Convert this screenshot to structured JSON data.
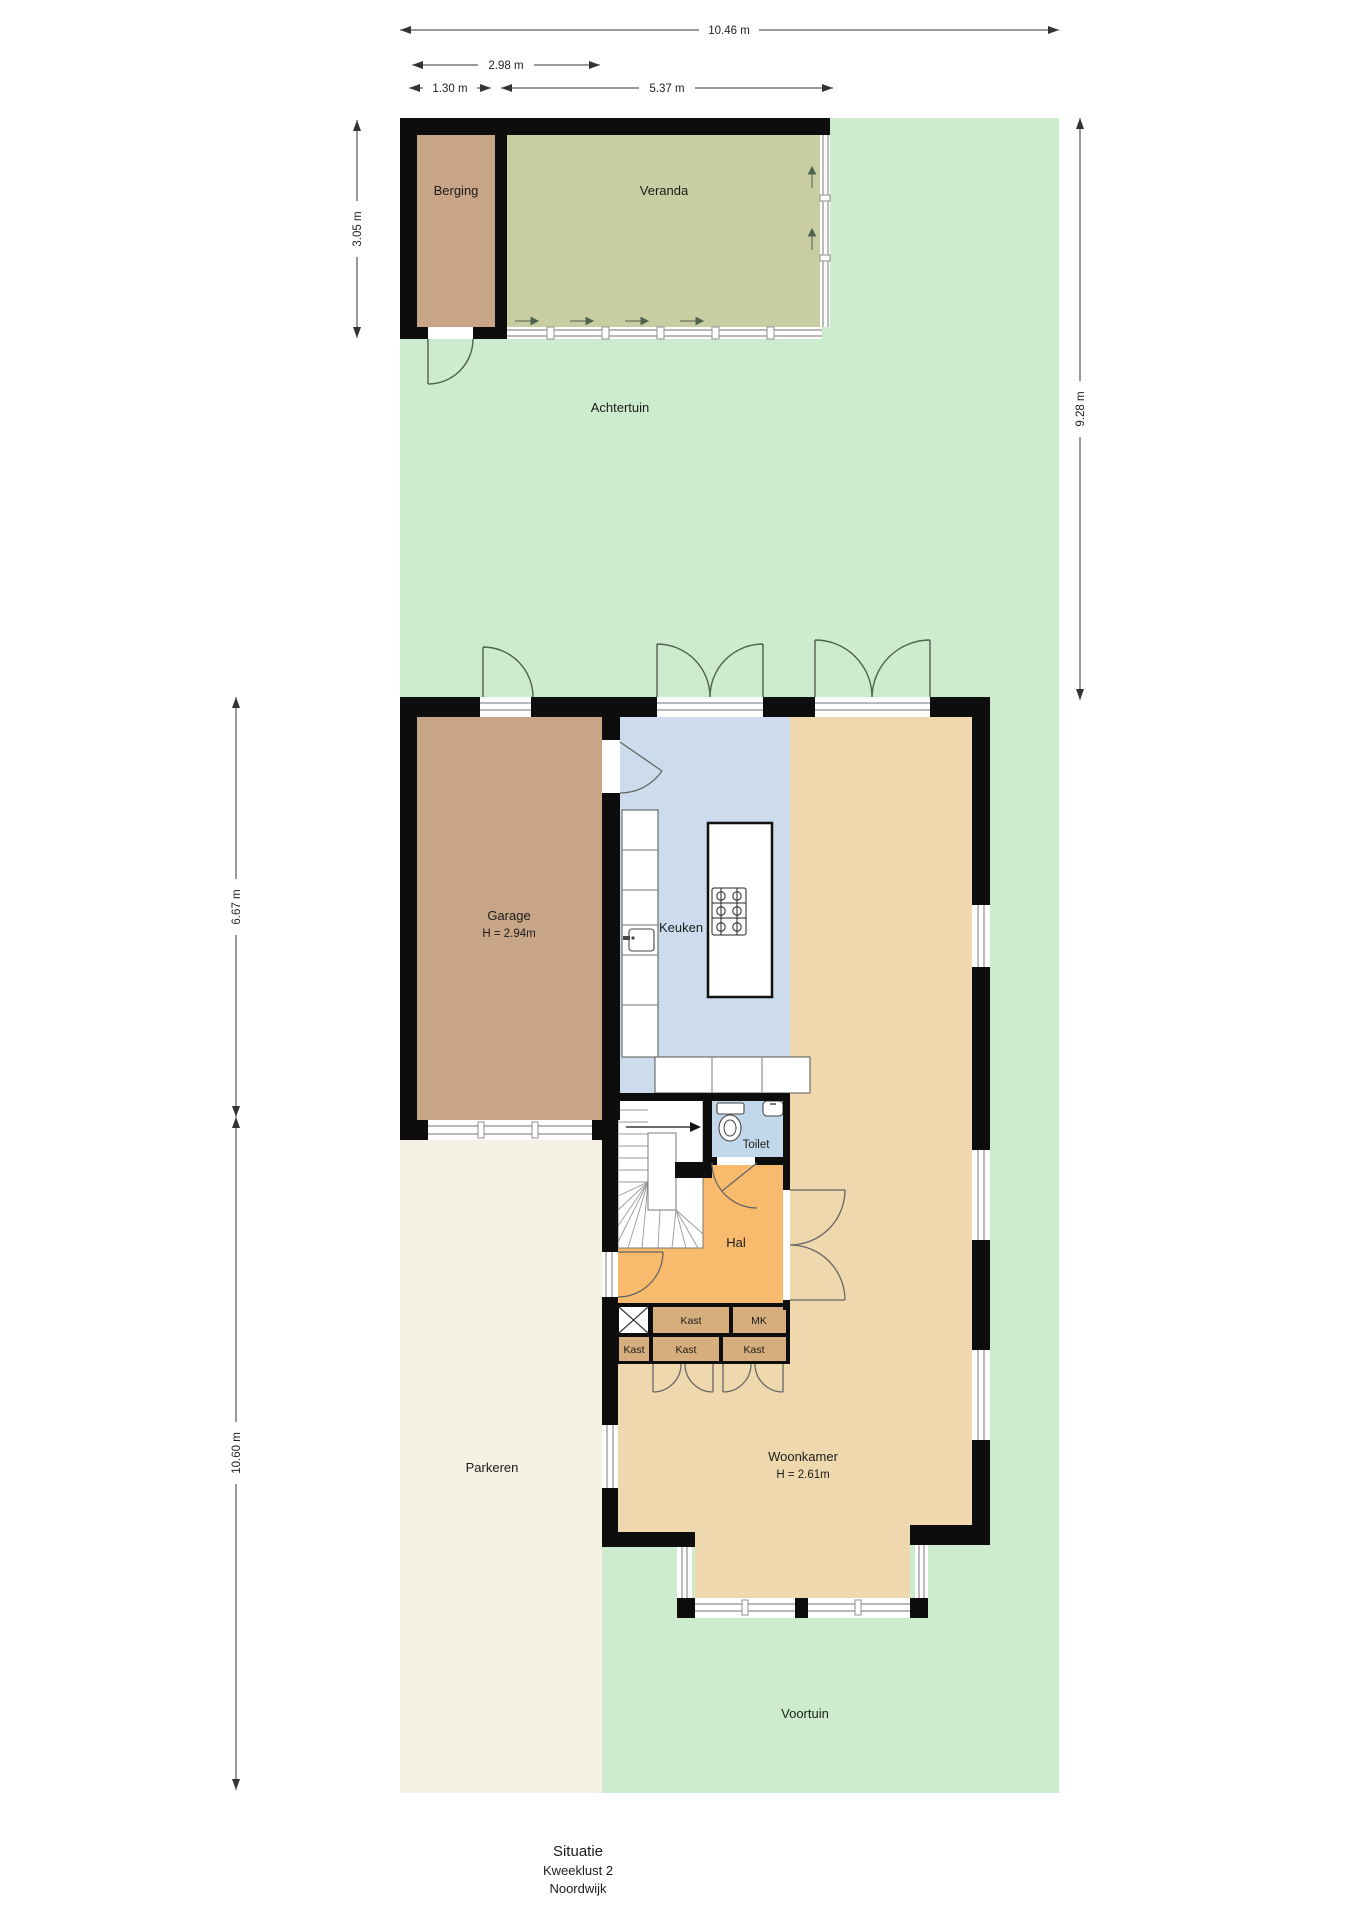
{
  "colors": {
    "garden": "#cdeccd",
    "parkeren": "#f4f1e4",
    "veranda": "#c9cda2",
    "berging": "#c7a586",
    "garage": "#c7a586",
    "kitchen": "#ccdcec",
    "toilet": "#c3d7ea",
    "woonkamer": "#f0d8ae",
    "hal": "#f8bb6e",
    "kast": "#d6ad7c",
    "wall": "#0d0d0d"
  },
  "labels": {
    "achtertuin": "Achtertuin",
    "voortuin": "Voortuin",
    "parkeren": "Parkeren",
    "berging": "Berging",
    "veranda": "Veranda",
    "garage": "Garage",
    "garage_height": "H = 2.94m",
    "keuken": "Keuken",
    "toilet": "Toilet",
    "hal": "Hal",
    "woonkamer": "Woonkamer",
    "woonkamer_height": "H = 2.61m",
    "kast": "Kast",
    "mk": "MK"
  },
  "dimensions": {
    "top_width": "10.46 m",
    "berging_total": "2.98 m",
    "berging_width": "1.30 m",
    "veranda_width": "5.37 m",
    "berging_depth": "3.05 m",
    "garden_depth": "9.28 m",
    "garage_section": "6.67 m",
    "front_section": "10.60 m"
  },
  "title": {
    "line1": "Situatie",
    "line2": "Kweeklust 2",
    "line3": "Noordwijk"
  }
}
